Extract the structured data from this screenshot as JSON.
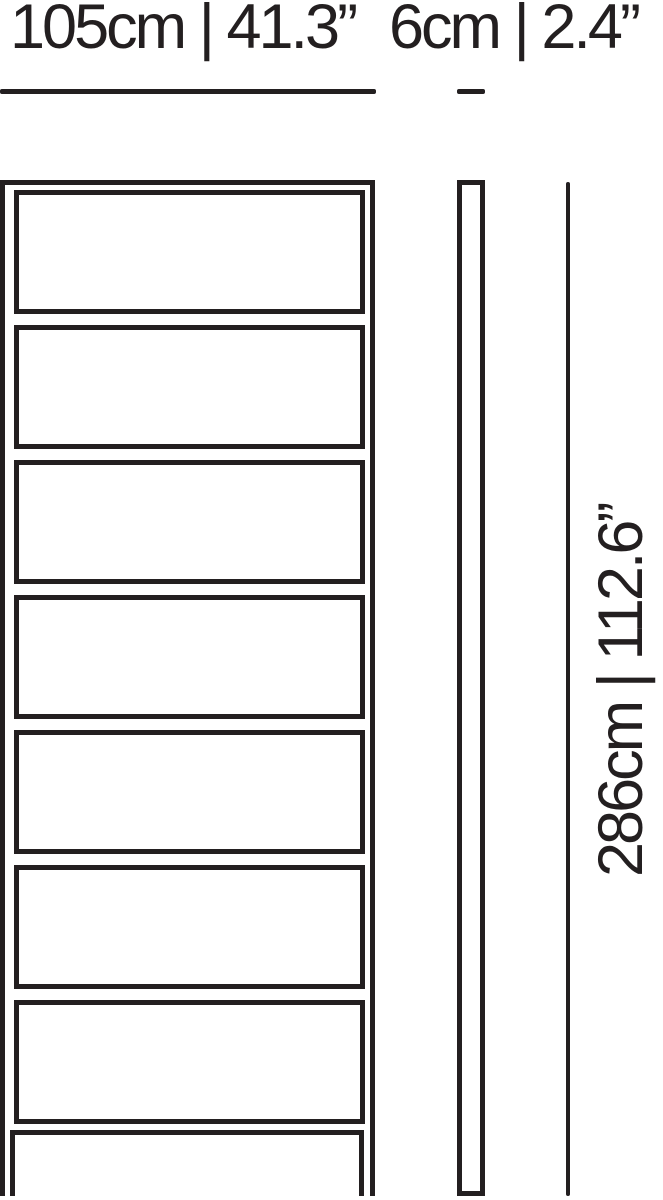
{
  "diagram": {
    "ink_color": "#231f20",
    "background_color": "#ffffff",
    "labels": {
      "width": "105cm | 41.3”",
      "depth": "6cm | 2.4”",
      "height": "286cm | 112.6”"
    },
    "front_view": {
      "compartments": 7
    }
  }
}
